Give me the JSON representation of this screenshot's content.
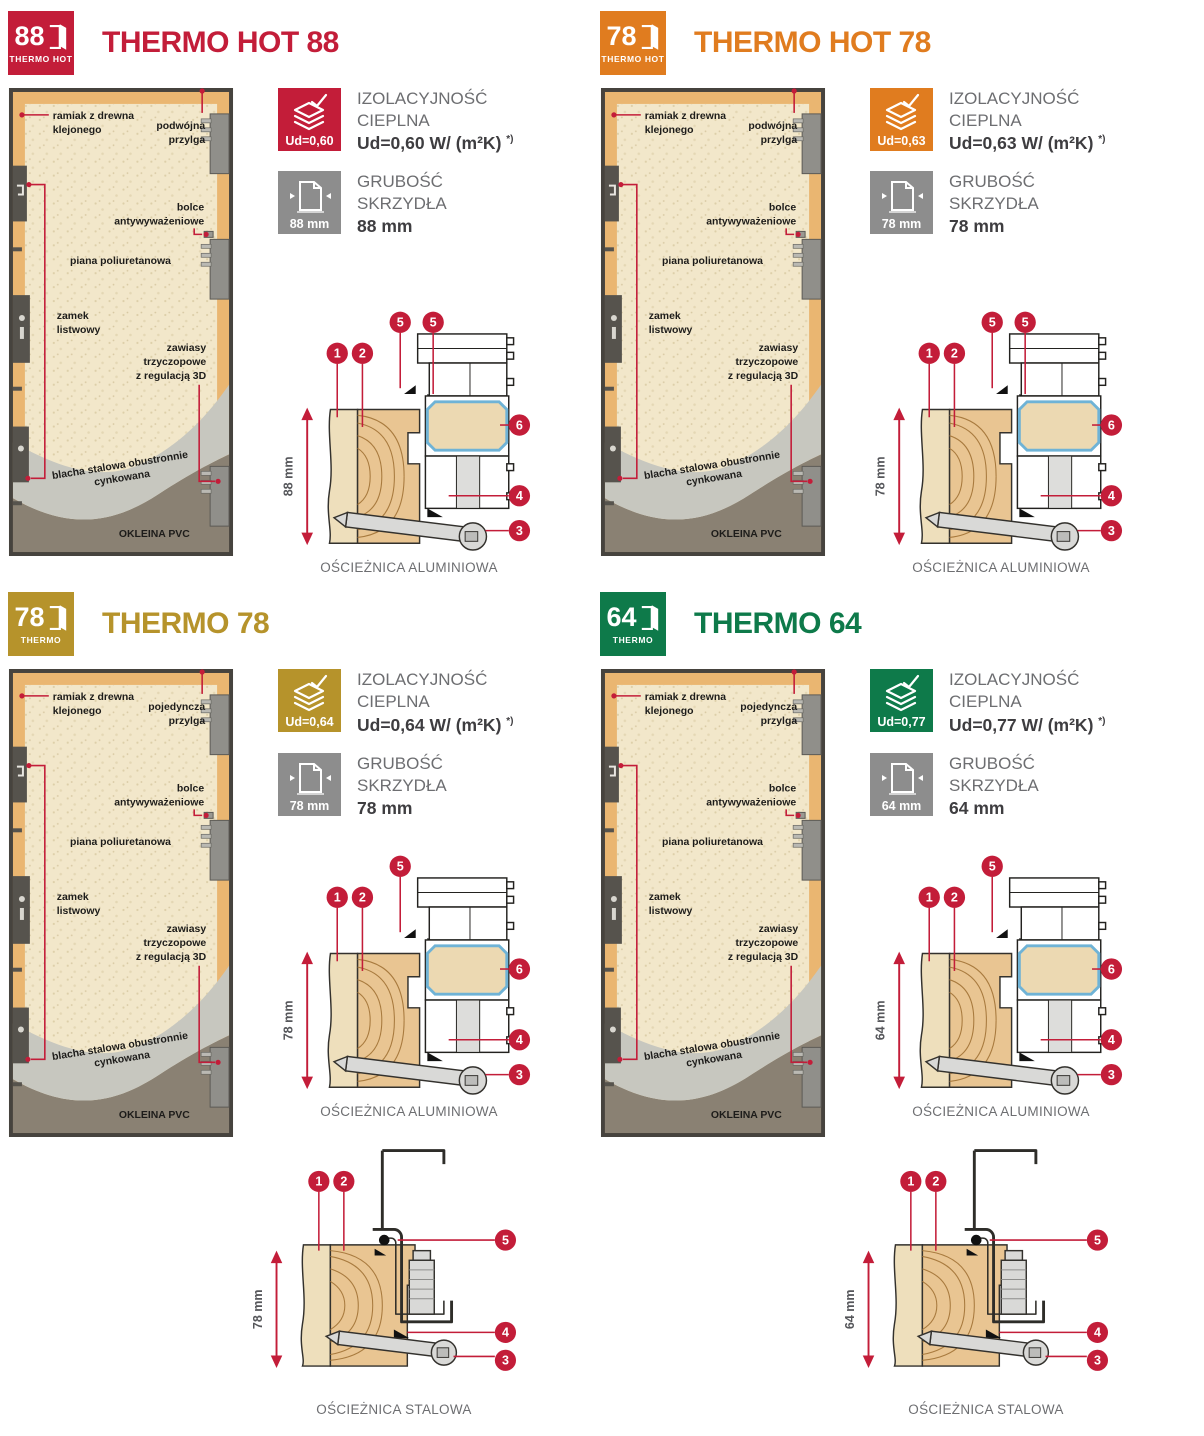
{
  "panels": [
    {
      "title": "THERMO HOT 88",
      "accent": "#c31d39",
      "logo": {
        "number": "88",
        "series": "THERMO HOT"
      },
      "door_labels": {
        "frame": [
          "ramiak z drewna",
          "klejonego"
        ],
        "rebate": [
          "podwójna",
          "przylga"
        ],
        "foam": "piana poliuretanowa",
        "bolts": [
          "bolce",
          "antywyważeniowe"
        ],
        "lock": [
          "zamek",
          "listwowy"
        ],
        "hinges": [
          "zawiasy",
          "trzyczopowe",
          "z regulacją 3D"
        ],
        "steel_sheet": [
          "blacha stalowa obustronnie",
          "cynkowana"
        ],
        "veneer": "OKLEINA PVC"
      },
      "insulation": {
        "badge": "Ud=0,60",
        "label": [
          "IZOLACYJNOŚĆ",
          "CIEPLNA"
        ],
        "value": "Ud=0,60 W/ (m²K)",
        "footnote": "*)"
      },
      "thickness": {
        "badge": "88 mm",
        "label": [
          "GRUBOŚĆ",
          "SKRZYDŁA"
        ],
        "value": "88 mm"
      },
      "diagram_alu": {
        "dimension": "88 mm",
        "caption": "OŚCIEŻNICA ALUMINIOWA",
        "callouts": {
          "c1": "1",
          "c2": "2",
          "c5a": "5",
          "c5b": "5",
          "c6": "6",
          "c4": "4",
          "c3": "3"
        }
      },
      "diagram_steel": null
    },
    {
      "title": "THERMO HOT 78",
      "accent": "#e07c1f",
      "logo": {
        "number": "78",
        "series": "THERMO HOT"
      },
      "door_labels": {
        "frame": [
          "ramiak z drewna",
          "klejonego"
        ],
        "rebate": [
          "podwójna",
          "przylga"
        ],
        "foam": "piana poliuretanowa",
        "bolts": [
          "bolce",
          "antywyważeniowe"
        ],
        "lock": [
          "zamek",
          "listwowy"
        ],
        "hinges": [
          "zawiasy",
          "trzyczopowe",
          "z regulacją 3D"
        ],
        "steel_sheet": [
          "blacha stalowa obustronnie",
          "cynkowana"
        ],
        "veneer": "OKLEINA PVC"
      },
      "insulation": {
        "badge": "Ud=0,63",
        "label": [
          "IZOLACYJNOŚĆ",
          "CIEPLNA"
        ],
        "value": "Ud=0,63 W/ (m²K)",
        "footnote": "*)"
      },
      "thickness": {
        "badge": "78 mm",
        "label": [
          "GRUBOŚĆ",
          "SKRZYDŁA"
        ],
        "value": "78 mm"
      },
      "diagram_alu": {
        "dimension": "78 mm",
        "caption": "OŚCIEŻNICA ALUMINIOWA",
        "callouts": {
          "c1": "1",
          "c2": "2",
          "c5a": "5",
          "c5b": "5",
          "c6": "6",
          "c4": "4",
          "c3": "3"
        }
      },
      "diagram_steel": null
    },
    {
      "title": "THERMO 78",
      "accent": "#b6932b",
      "logo": {
        "number": "78",
        "series": "THERMO"
      },
      "door_labels": {
        "frame": [
          "ramiak z drewna",
          "klejonego"
        ],
        "rebate": [
          "pojedyncza",
          "przylga"
        ],
        "foam": "piana poliuretanowa",
        "bolts": [
          "bolce",
          "antywyważeniowe"
        ],
        "lock": [
          "zamek",
          "listwowy"
        ],
        "hinges": [
          "zawiasy",
          "trzyczopowe",
          "z regulacją 3D"
        ],
        "steel_sheet": [
          "blacha stalowa obustronnie",
          "cynkowana"
        ],
        "veneer": "OKLEINA PVC"
      },
      "insulation": {
        "badge": "Ud=0,64",
        "label": [
          "IZOLACYJNOŚĆ",
          "CIEPLNA"
        ],
        "value": "Ud=0,64 W/ (m²K)",
        "footnote": "*)"
      },
      "thickness": {
        "badge": "78 mm",
        "label": [
          "GRUBOŚĆ",
          "SKRZYDŁA"
        ],
        "value": "78 mm"
      },
      "diagram_alu": {
        "dimension": "78 mm",
        "caption": "OŚCIEŻNICA ALUMINIOWA",
        "callouts": {
          "c1": "1",
          "c2": "2",
          "c5a": "5",
          "c6": "6",
          "c4": "4",
          "c3": "3"
        }
      },
      "diagram_steel": {
        "dimension": "78 mm",
        "caption": "OŚCIEŻNICA STALOWA",
        "callouts": {
          "c1": "1",
          "c2": "2",
          "c5": "5",
          "c4": "4",
          "c3": "3"
        }
      }
    },
    {
      "title": "THERMO 64",
      "accent": "#0e7a4a",
      "logo": {
        "number": "64",
        "series": "THERMO"
      },
      "door_labels": {
        "frame": [
          "ramiak z drewna",
          "klejonego"
        ],
        "rebate": [
          "pojedyncza",
          "przylga"
        ],
        "foam": "piana poliuretanowa",
        "bolts": [
          "bolce",
          "antywyważeniowe"
        ],
        "lock": [
          "zamek",
          "listwowy"
        ],
        "hinges": [
          "zawiasy",
          "trzyczopowe",
          "z regulacją 3D"
        ],
        "steel_sheet": [
          "blacha stalowa obustronnie",
          "cynkowana"
        ],
        "veneer": "OKLEINA PVC"
      },
      "insulation": {
        "badge": "Ud=0,77",
        "label": [
          "IZOLACYJNOŚĆ",
          "CIEPLNA"
        ],
        "value": "Ud=0,77 W/ (m²K)",
        "footnote": "*)"
      },
      "thickness": {
        "badge": "64 mm",
        "label": [
          "GRUBOŚĆ",
          "SKRZYDŁA"
        ],
        "value": "64 mm"
      },
      "diagram_alu": {
        "dimension": "64 mm",
        "caption": "OŚCIEŻNICA ALUMINIOWA",
        "callouts": {
          "c1": "1",
          "c2": "2",
          "c5a": "5",
          "c6": "6",
          "c4": "4",
          "c3": "3"
        }
      },
      "diagram_steel": {
        "dimension": "64 mm",
        "caption": "OŚCIEŻNICA STALOWA",
        "callouts": {
          "c1": "1",
          "c2": "2",
          "c5": "5",
          "c4": "4",
          "c3": "3"
        }
      }
    }
  ]
}
